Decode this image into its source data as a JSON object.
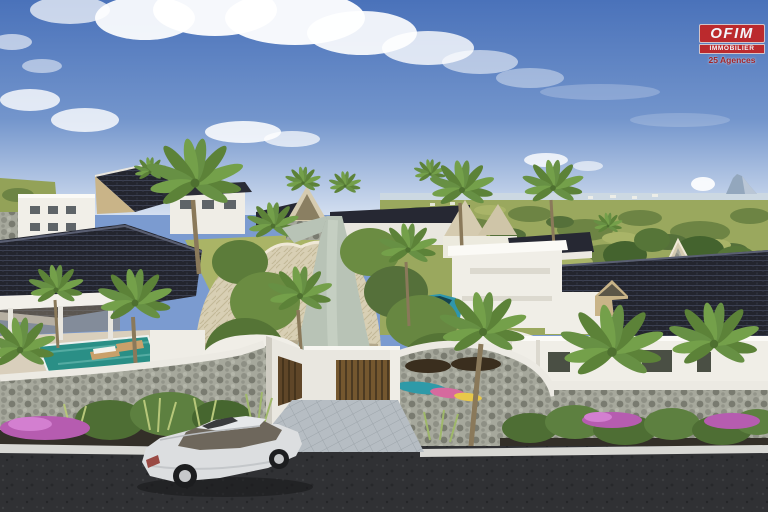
{
  "scene": {
    "description": "Aerial 3D architectural rendering of a tropical gated villa residence: white villas with dark shingle and beige thatch roofs, palm trees, a winding interior lane, curved stone entrance walls with wooden gates, pink flower beds, a teal hatchback inside the compound and a silver sedan on the asphalt street in the foreground, under a blue sky with clouds and a distant green plain with a mountain on the horizon"
  },
  "logo": {
    "brand": "OFIM",
    "subtitle": "IMMOBILIER",
    "tagline": "25 Agences",
    "bg_color": "#c32423",
    "text_color": "#ffffff"
  },
  "palette": {
    "sky_top": "#4a72ba",
    "sky_horizon": "#d3dff0",
    "cloud": "#ffffff",
    "sea": "#ccd8e2",
    "mountain": "#93a7bd",
    "landscape": "#9aa85e",
    "tree_dark": "#44632e",
    "roof_shingle": "#23252e",
    "roof_thatch": "#d8cfb4",
    "wall_white": "#f0eee7",
    "stone_wall": "#a6a89c",
    "gate_wood": "#74572f",
    "pool": "#2a8f86",
    "lane": "#b8c3b6",
    "pavers": "#b6bdc3",
    "asphalt": "#303134",
    "flowers": "#b65cb0",
    "sedan_silver": "#dcdee0",
    "hatchback_teal": "#2f96ac"
  }
}
